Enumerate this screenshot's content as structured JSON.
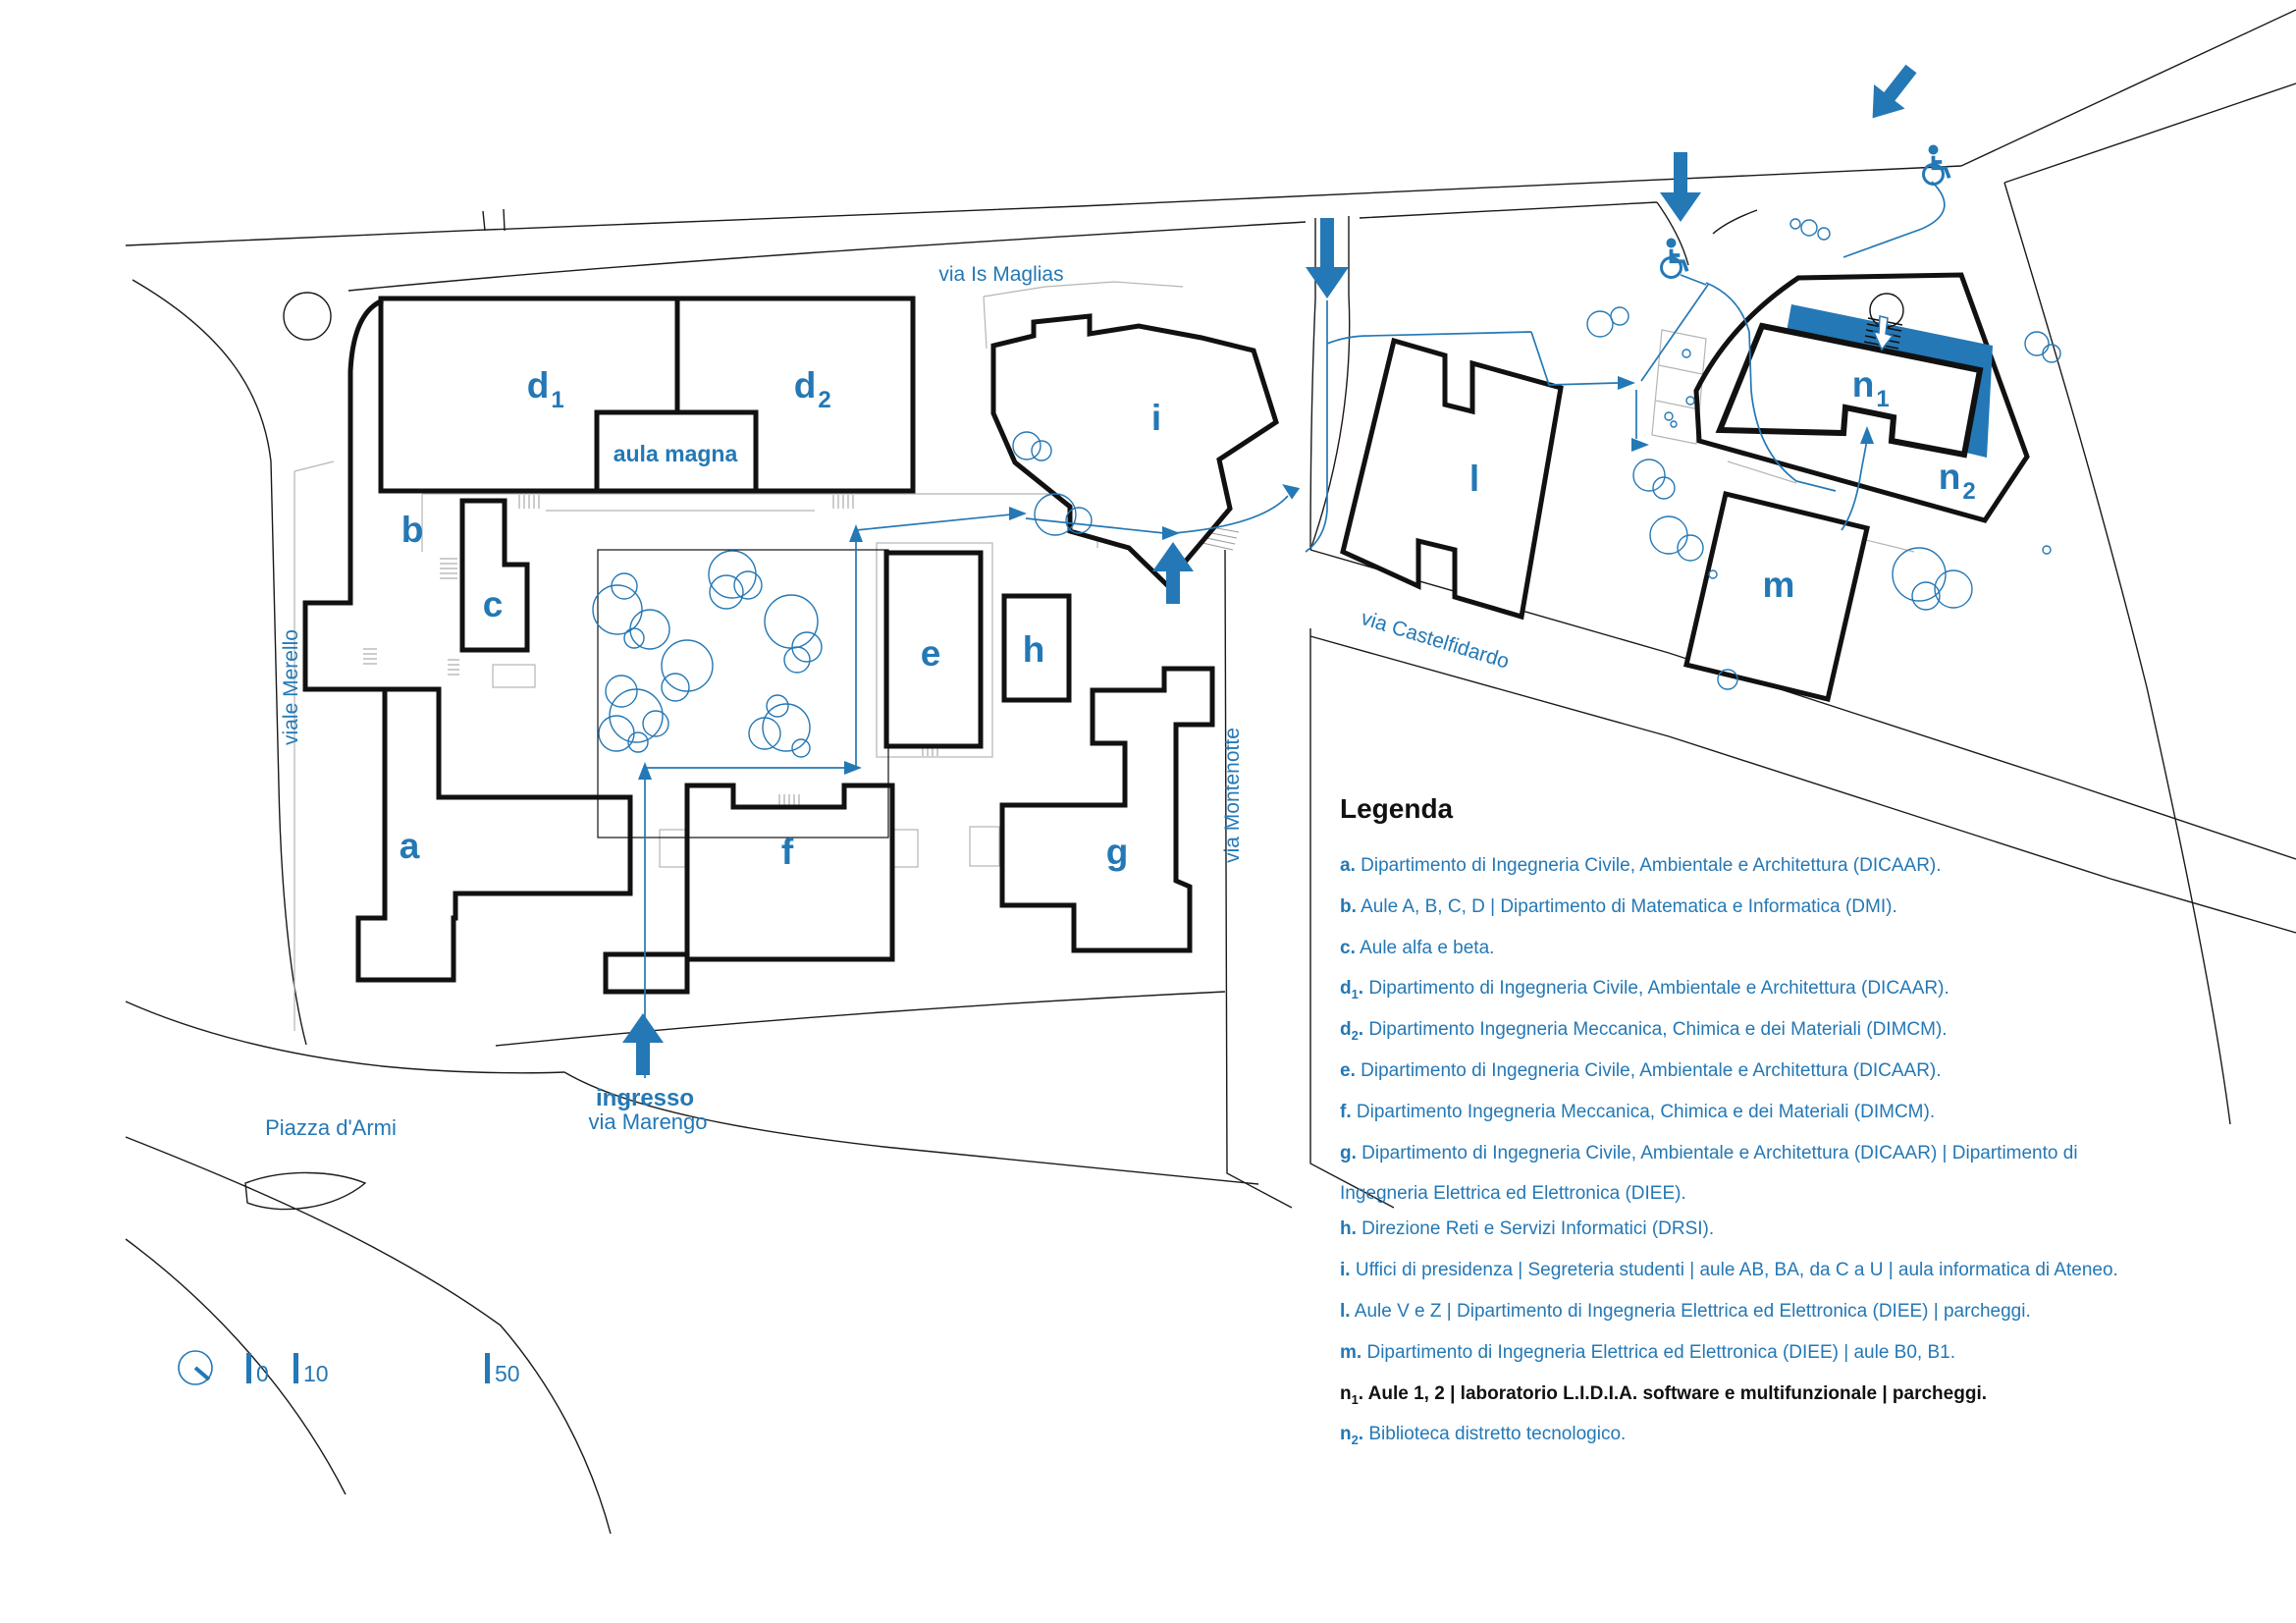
{
  "map": {
    "streets": {
      "is_maglias": "via Is Maglias",
      "merello": "viale Merello",
      "castelfidardo": "via Castelfidardo",
      "montenotte": "via Montenotte",
      "piazza_armi": "Piazza d'Armi"
    },
    "entrance": {
      "line1": "ingresso",
      "line2": "via Marengo"
    },
    "aula_magna": "aula magna",
    "buildings": {
      "a": {
        "label": "a"
      },
      "b": {
        "label": "b"
      },
      "c": {
        "label": "c"
      },
      "d1": {
        "base": "d",
        "sub": "1"
      },
      "d2": {
        "base": "d",
        "sub": "2"
      },
      "e": {
        "label": "e"
      },
      "f": {
        "label": "f"
      },
      "g": {
        "label": "g"
      },
      "h": {
        "label": "h"
      },
      "i": {
        "label": "i"
      },
      "l": {
        "label": "l"
      },
      "m": {
        "label": "m"
      },
      "n1": {
        "base": "n",
        "sub": "1"
      },
      "n2": {
        "base": "n",
        "sub": "2"
      }
    },
    "scale": {
      "t0": "0",
      "t10": "10",
      "t50": "50"
    },
    "icons": [
      "wheelchair-icon",
      "entrance-arrow-icon",
      "north-compass-icon",
      "tree-icon",
      "stairs-icon"
    ],
    "colors": {
      "accent_blue": "#2478b5",
      "line_black": "#1a1a1a",
      "parcel_gray": "#b5b5b5",
      "background": "#ffffff"
    }
  },
  "legend": {
    "title": "Legenda",
    "items": [
      {
        "key": "a",
        "sub": "",
        "dot": ".",
        "text": "Dipartimento di Ingegneria Civile, Ambientale e Architettura (DICAAR).",
        "text2": ""
      },
      {
        "key": "b",
        "sub": "",
        "dot": ".",
        "text": "Aule A, B, C, D | Dipartimento di Matematica e Informatica (DMI).",
        "text2": ""
      },
      {
        "key": "c",
        "sub": "",
        "dot": ".",
        "text": "Aule alfa e beta.",
        "text2": ""
      },
      {
        "key": "d",
        "sub": "1",
        "dot": ".",
        "text": "Dipartimento di Ingegneria Civile, Ambientale e Architettura (DICAAR).",
        "text2": ""
      },
      {
        "key": "d",
        "sub": "2",
        "dot": ".",
        "text": "Dipartimento Ingegneria Meccanica, Chimica e dei Materiali (DIMCM).",
        "text2": ""
      },
      {
        "key": "e",
        "sub": "",
        "dot": ".",
        "text": "Dipartimento di Ingegneria Civile, Ambientale e Architettura (DICAAR).",
        "text2": ""
      },
      {
        "key": "f",
        "sub": "",
        "dot": ".",
        "text": "Dipartimento Ingegneria Meccanica, Chimica e dei Materiali (DIMCM).",
        "text2": ""
      },
      {
        "key": "g",
        "sub": "",
        "dot": ".",
        "text": "Dipartimento di Ingegneria Civile, Ambientale e Architettura (DICAAR) | Dipartimento di",
        "text2": "Ingegneria Elettrica ed Elettronica (DIEE)."
      },
      {
        "key": "h",
        "sub": "",
        "dot": ".",
        "text": "Direzione Reti e Servizi Informatici (DRSI).",
        "text2": ""
      },
      {
        "key": "i",
        "sub": "",
        "dot": ".",
        "text": "Uffici di presidenza | Segreteria studenti | aule AB, BA, da C a U | aula informatica di Ateneo.",
        "text2": ""
      },
      {
        "key": "l",
        "sub": "",
        "dot": ".",
        "text": "Aule V e Z | Dipartimento di Ingegneria Elettrica ed Elettronica (DIEE) | parcheggi.",
        "text2": ""
      },
      {
        "key": "m",
        "sub": "",
        "dot": ".",
        "text": "Dipartimento di Ingegneria Elettrica ed Elettronica (DIEE) | aule B0, B1.",
        "text2": ""
      },
      {
        "key": "n",
        "sub": "1",
        "dot": ".",
        "text": "Aule 1, 2 | laboratorio L.I.D.I.A. software e multifunzionale | parcheggi.",
        "text2": ""
      },
      {
        "key": "n",
        "sub": "2",
        "dot": ".",
        "text": "Biblioteca distretto tecnologico.",
        "text2": ""
      }
    ]
  }
}
